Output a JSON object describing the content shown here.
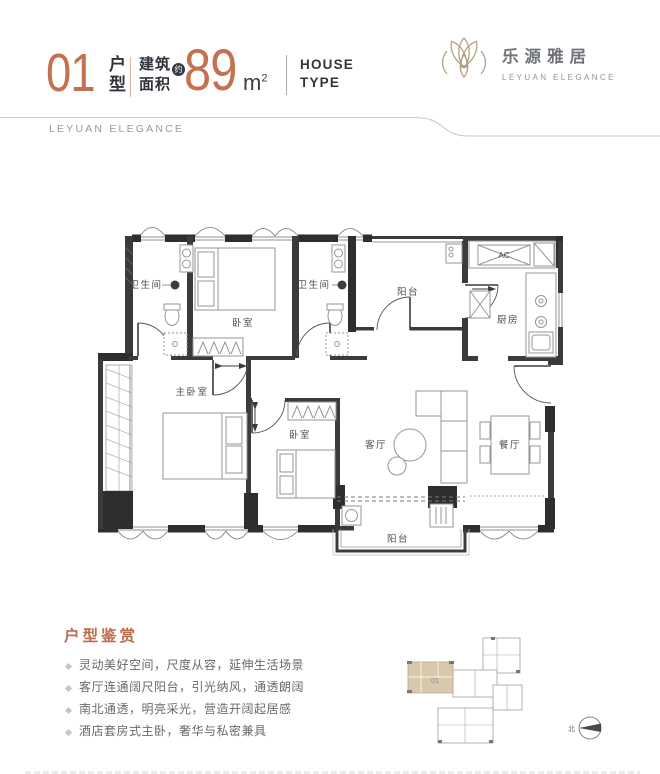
{
  "header": {
    "unit_number": "01",
    "unit_label_top": "户",
    "unit_label_bottom": "型",
    "area_label_top": "建筑",
    "area_label_bottom": "面积",
    "area_approx_badge": "约",
    "area_value": "89",
    "area_unit_base": "m",
    "area_unit_sup": "2",
    "house_type_top": "HOUSE",
    "house_type_bottom": "TYPE"
  },
  "brand": {
    "name_cn": "乐源雅居",
    "name_en": "LEYUAN ELEGANCE"
  },
  "banner": {
    "text": "LEYUAN ELEGANCE"
  },
  "floor_plan": {
    "rooms": {
      "bathroom_left": "卫生间",
      "bedroom_top": "卧室",
      "bathroom_right": "卫生间",
      "balcony_top": "阳台",
      "kitchen": "厨房",
      "ac_unit": "AC",
      "master_bedroom": "主卧室",
      "bedroom_second": "卧室",
      "living_room": "客厅",
      "dining_room": "餐厅",
      "balcony_bottom": "阳台"
    }
  },
  "features": {
    "title": "户型鉴赏",
    "items": [
      "灵动美好空间，尺度从容，延伸生活场景",
      "客厅连通阔尺阳台，引光纳风，通透朗阔",
      "南北通透，明亮采光，营造开阔起居感",
      "酒店套房式主卧，奢华与私密兼具"
    ]
  },
  "keyplan": {
    "unit_label": "01",
    "north_label": "北"
  },
  "colors": {
    "accent": "#c4714f",
    "dark": "#31353b",
    "gold": "#b2a182",
    "tan": "#d9c9ab",
    "wall": "#3b3b3b"
  }
}
